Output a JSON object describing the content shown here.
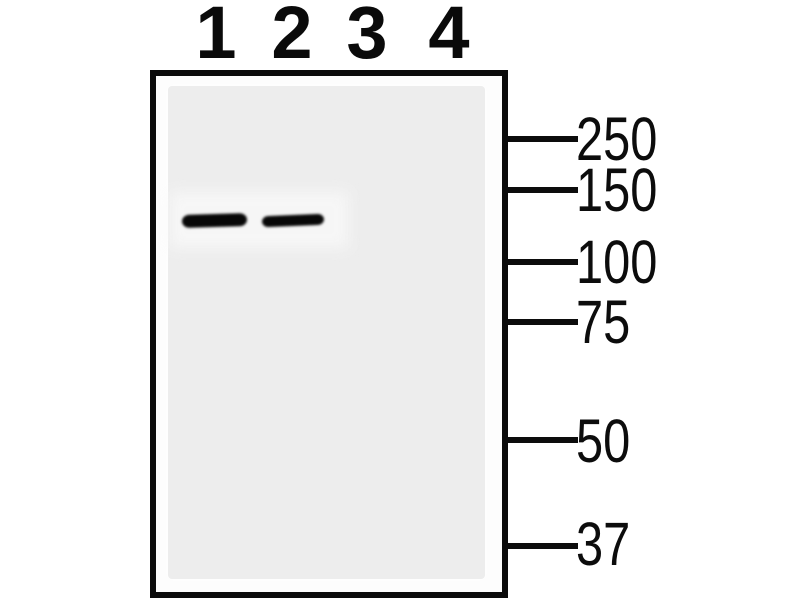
{
  "figure": {
    "lane_labels": [
      "1",
      "2",
      "3",
      "4"
    ],
    "mw_markers": [
      {
        "label": "250"
      },
      {
        "label": "150"
      },
      {
        "label": "100"
      },
      {
        "label": "75"
      },
      {
        "label": "50"
      },
      {
        "label": "37"
      }
    ],
    "bands": [
      {
        "lane": "1",
        "between_markers": "150-100"
      },
      {
        "lane": "2",
        "between_markers": "150-100"
      }
    ],
    "colors": {
      "background": "#ffffff",
      "membrane": "#ededed",
      "frame_ink": "#0b0b0b",
      "band": "#070707"
    }
  }
}
